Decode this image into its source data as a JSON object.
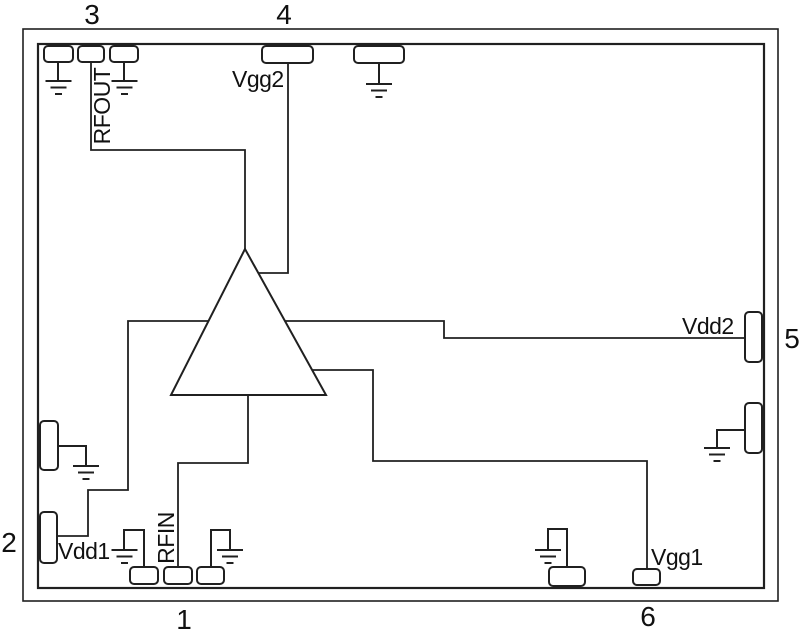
{
  "pins": [
    {
      "number": "1",
      "side": "bottom"
    },
    {
      "number": "2",
      "side": "left"
    },
    {
      "number": "3",
      "side": "top"
    },
    {
      "number": "4",
      "side": "top"
    },
    {
      "number": "5",
      "side": "right"
    },
    {
      "number": "6",
      "side": "bottom"
    }
  ],
  "nets": {
    "rfout": "RFOUT",
    "vgg2": "Vgg2",
    "vdd2": "Vdd2",
    "vdd1": "Vdd1",
    "rfin": "RFIN",
    "vgg1": "Vgg1"
  },
  "colors": {
    "line": "#202020",
    "background": "#ffffff",
    "pad_fill": "#ffffff"
  }
}
